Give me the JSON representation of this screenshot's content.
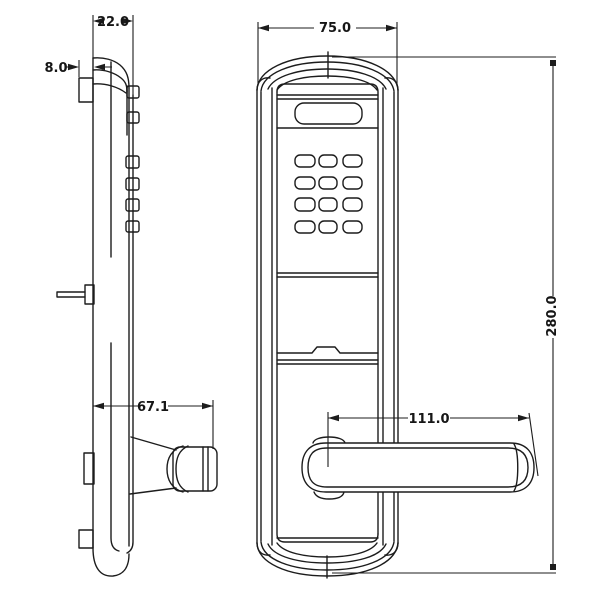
{
  "colors": {
    "background": "#ffffff",
    "line": "#1c1c1c"
  },
  "dimensions": {
    "body_thickness": "22.0",
    "edge_offset": "8.0",
    "faceplate_width": "75.0",
    "faceplate_height": "280.0",
    "handle_profile_depth": "67.1",
    "handle_length": "111.0"
  }
}
